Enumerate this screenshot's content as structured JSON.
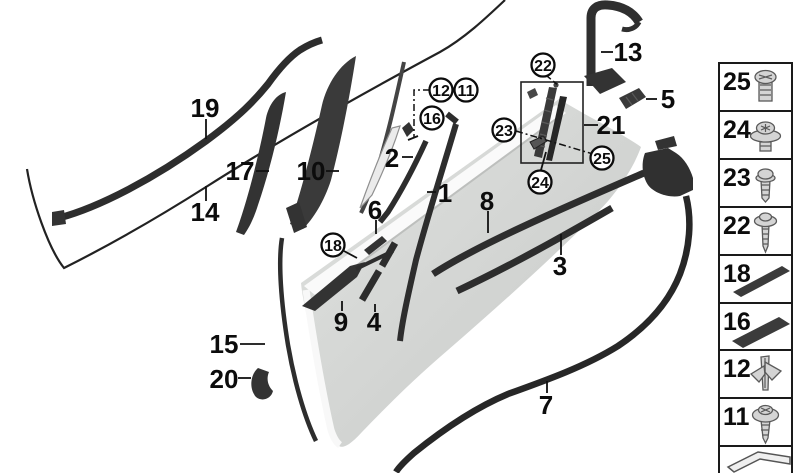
{
  "diagram": {
    "type": "exploded-parts-diagram",
    "subject": "door trims and seals",
    "colors": {
      "door_fill": "#d6d8d6",
      "part_fill": "#2f2f2f",
      "line": "#111111",
      "background": "#ffffff"
    },
    "callouts": {
      "n19": "19",
      "n14": "14",
      "n17": "17",
      "n10": "10",
      "n2": "2",
      "n1": "1",
      "n6": "6",
      "n9": "9",
      "n4": "4",
      "n8": "8",
      "n3": "3",
      "n15": "15",
      "n20": "20",
      "n7": "7",
      "n13": "13",
      "n5": "5",
      "n21": "21"
    },
    "circled": {
      "n11": "11",
      "n12": "12",
      "n16": "16",
      "n18": "18",
      "n22": "22",
      "n23": "23",
      "n24": "24",
      "n25": "25"
    }
  },
  "legend": {
    "rows": [
      {
        "num": "25",
        "icon": "screw-pan-head-icon"
      },
      {
        "num": "24",
        "icon": "screw-washer-torx-icon"
      },
      {
        "num": "23",
        "icon": "screw-flange-icon"
      },
      {
        "num": "22",
        "icon": "screw-washer-long-icon"
      },
      {
        "num": "18",
        "icon": "adhesive-strip-thin-icon"
      },
      {
        "num": "16",
        "icon": "adhesive-strip-wide-icon"
      },
      {
        "num": "12",
        "icon": "plastic-clip-icon"
      },
      {
        "num": "11",
        "icon": "screw-round-washer-icon"
      },
      {
        "num": "",
        "icon": "folded-seal-arrow-icon"
      }
    ]
  }
}
